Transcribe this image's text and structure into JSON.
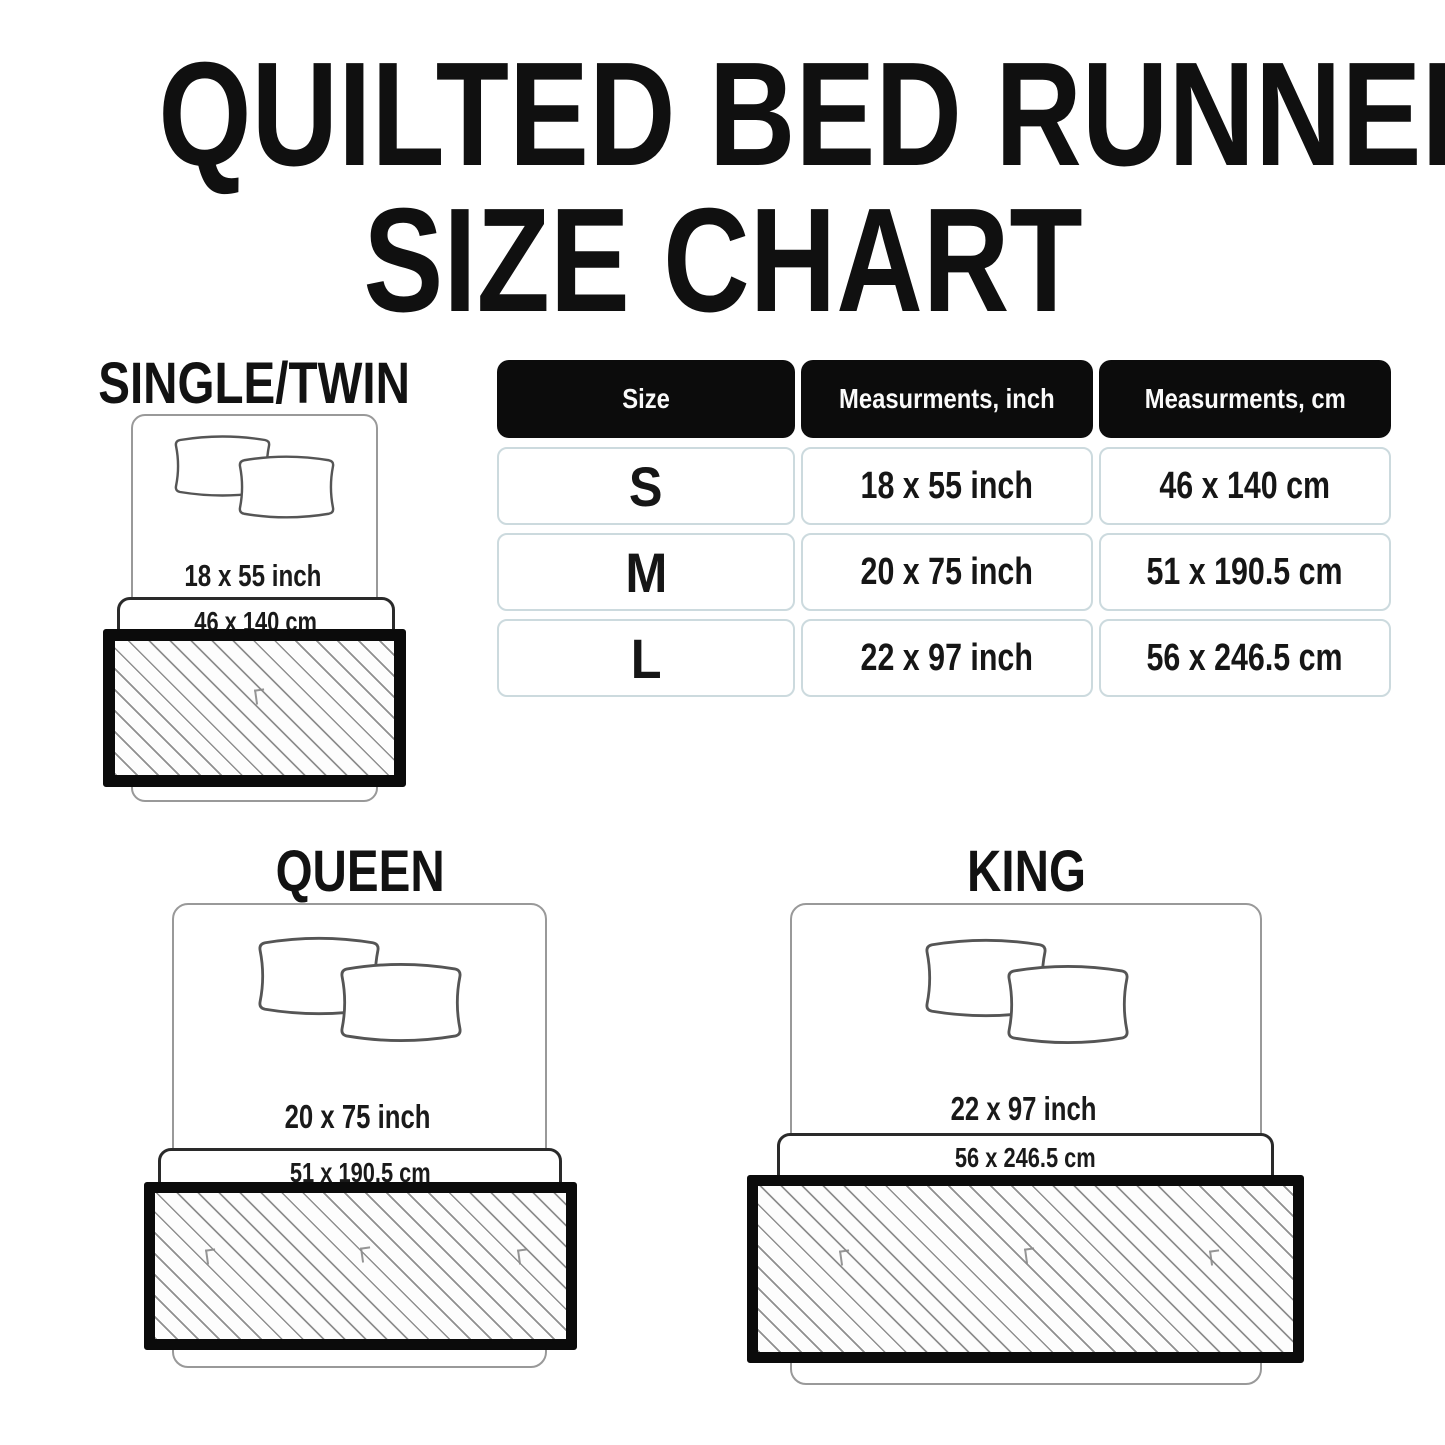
{
  "title": {
    "line1": "QUILTED BED RUNNER",
    "line2": "SIZE CHART"
  },
  "table": {
    "headers": [
      "Size",
      "Measurments, inch",
      "Measurments, cm"
    ],
    "rows": [
      {
        "size": "S",
        "inch": "18 x 55 inch",
        "cm": "46 x 140 cm"
      },
      {
        "size": "M",
        "inch": "20 x 75 inch",
        "cm": "51 x 190.5 cm"
      },
      {
        "size": "L",
        "inch": "22 x 97 inch",
        "cm": "56 x 246.5 cm"
      }
    ]
  },
  "diagrams": {
    "single": {
      "label": "SINGLE/TWIN",
      "inch": "18 x 55 inch",
      "cm": "46 x 140 cm"
    },
    "queen": {
      "label": "QUEEN",
      "inch": "20 x 75 inch",
      "cm": "51 x 190.5 cm"
    },
    "king": {
      "label": "KING",
      "inch": "22 x 97 inch",
      "cm": "56 x 246.5 cm"
    }
  },
  "colors": {
    "text": "#141414",
    "table_header_bg": "#0c0c0c",
    "table_header_text": "#fafafa",
    "cell_border": "#ccdade",
    "bed_outline": "#999999",
    "band_outline": "#2a2a2a",
    "runner_border": "#0b0b0b",
    "hatch_line": "#8f8f8f",
    "background": "#ffffff"
  },
  "icons": {
    "pillow": "pillow-outline",
    "runner": "diagonal-hatch-runner"
  }
}
